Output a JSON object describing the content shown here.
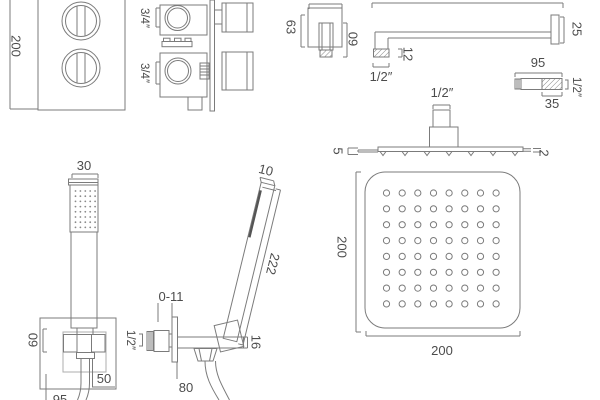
{
  "colors": {
    "line": "#7b7b7b",
    "line_light": "#adadad",
    "text": "#4c4c4c",
    "background": "#ffffff"
  },
  "valve_front": {
    "height_mm": "200"
  },
  "valve_side": {
    "top_port": "3/4″",
    "bottom_port": "3/4″"
  },
  "wall_outlet": {
    "width_mm": "63",
    "depth_mm": "60"
  },
  "shower_arm": {
    "flange_mm": "25",
    "tip_mm": "12",
    "thread": "1/2″"
  },
  "wall_union": {
    "length_mm": "95",
    "thread_mm": "35",
    "thread_size": "1/2″"
  },
  "head_side": {
    "thread": "1/2″",
    "edge_mm": "5",
    "nozzle_mm": "2",
    "nozzle_count": 7
  },
  "head_face": {
    "height_mm": "200",
    "width_mm": "200",
    "hole_rows": 8,
    "hole_cols": 8
  },
  "handset_front": {
    "width_mm": "30",
    "dot_rows": 8,
    "dot_cols": 5
  },
  "handset_side": {
    "tip_mm": "10",
    "length_mm": "222"
  },
  "outlet_bracket_front": {
    "height_mm": "60",
    "offset_mm": "50",
    "drop_mm": "95"
  },
  "outlet_bracket_side": {
    "adjust_mm": "0-11",
    "thread": "1/2″",
    "depth_mm": "80",
    "cradle_mm": "16"
  }
}
